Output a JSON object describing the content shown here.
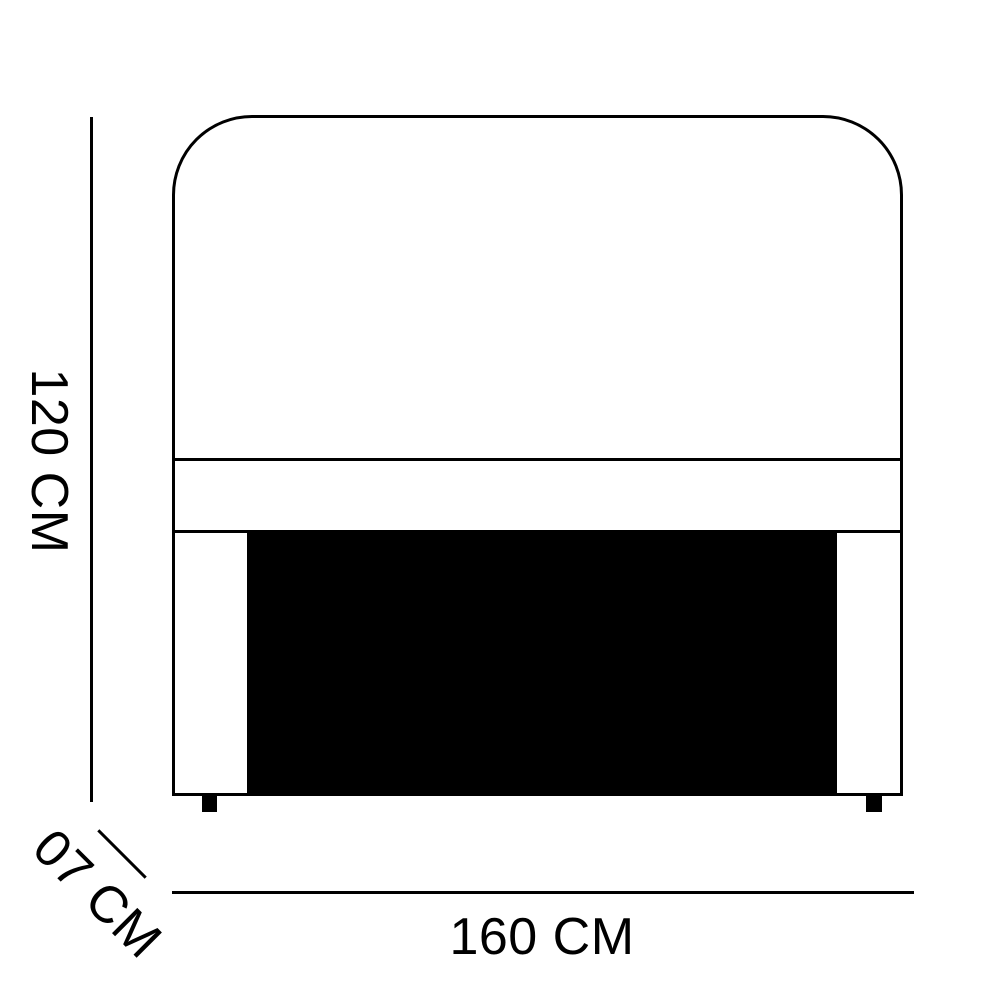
{
  "diagram": {
    "name": "headboard-dimension-diagram",
    "background_color": "#ffffff",
    "line_color": "#000000",
    "panel_color": "#000000",
    "dimensions": {
      "height": {
        "label": "120 CM"
      },
      "depth": {
        "label": "07 CM"
      },
      "width": {
        "label": "160 CM"
      }
    }
  }
}
